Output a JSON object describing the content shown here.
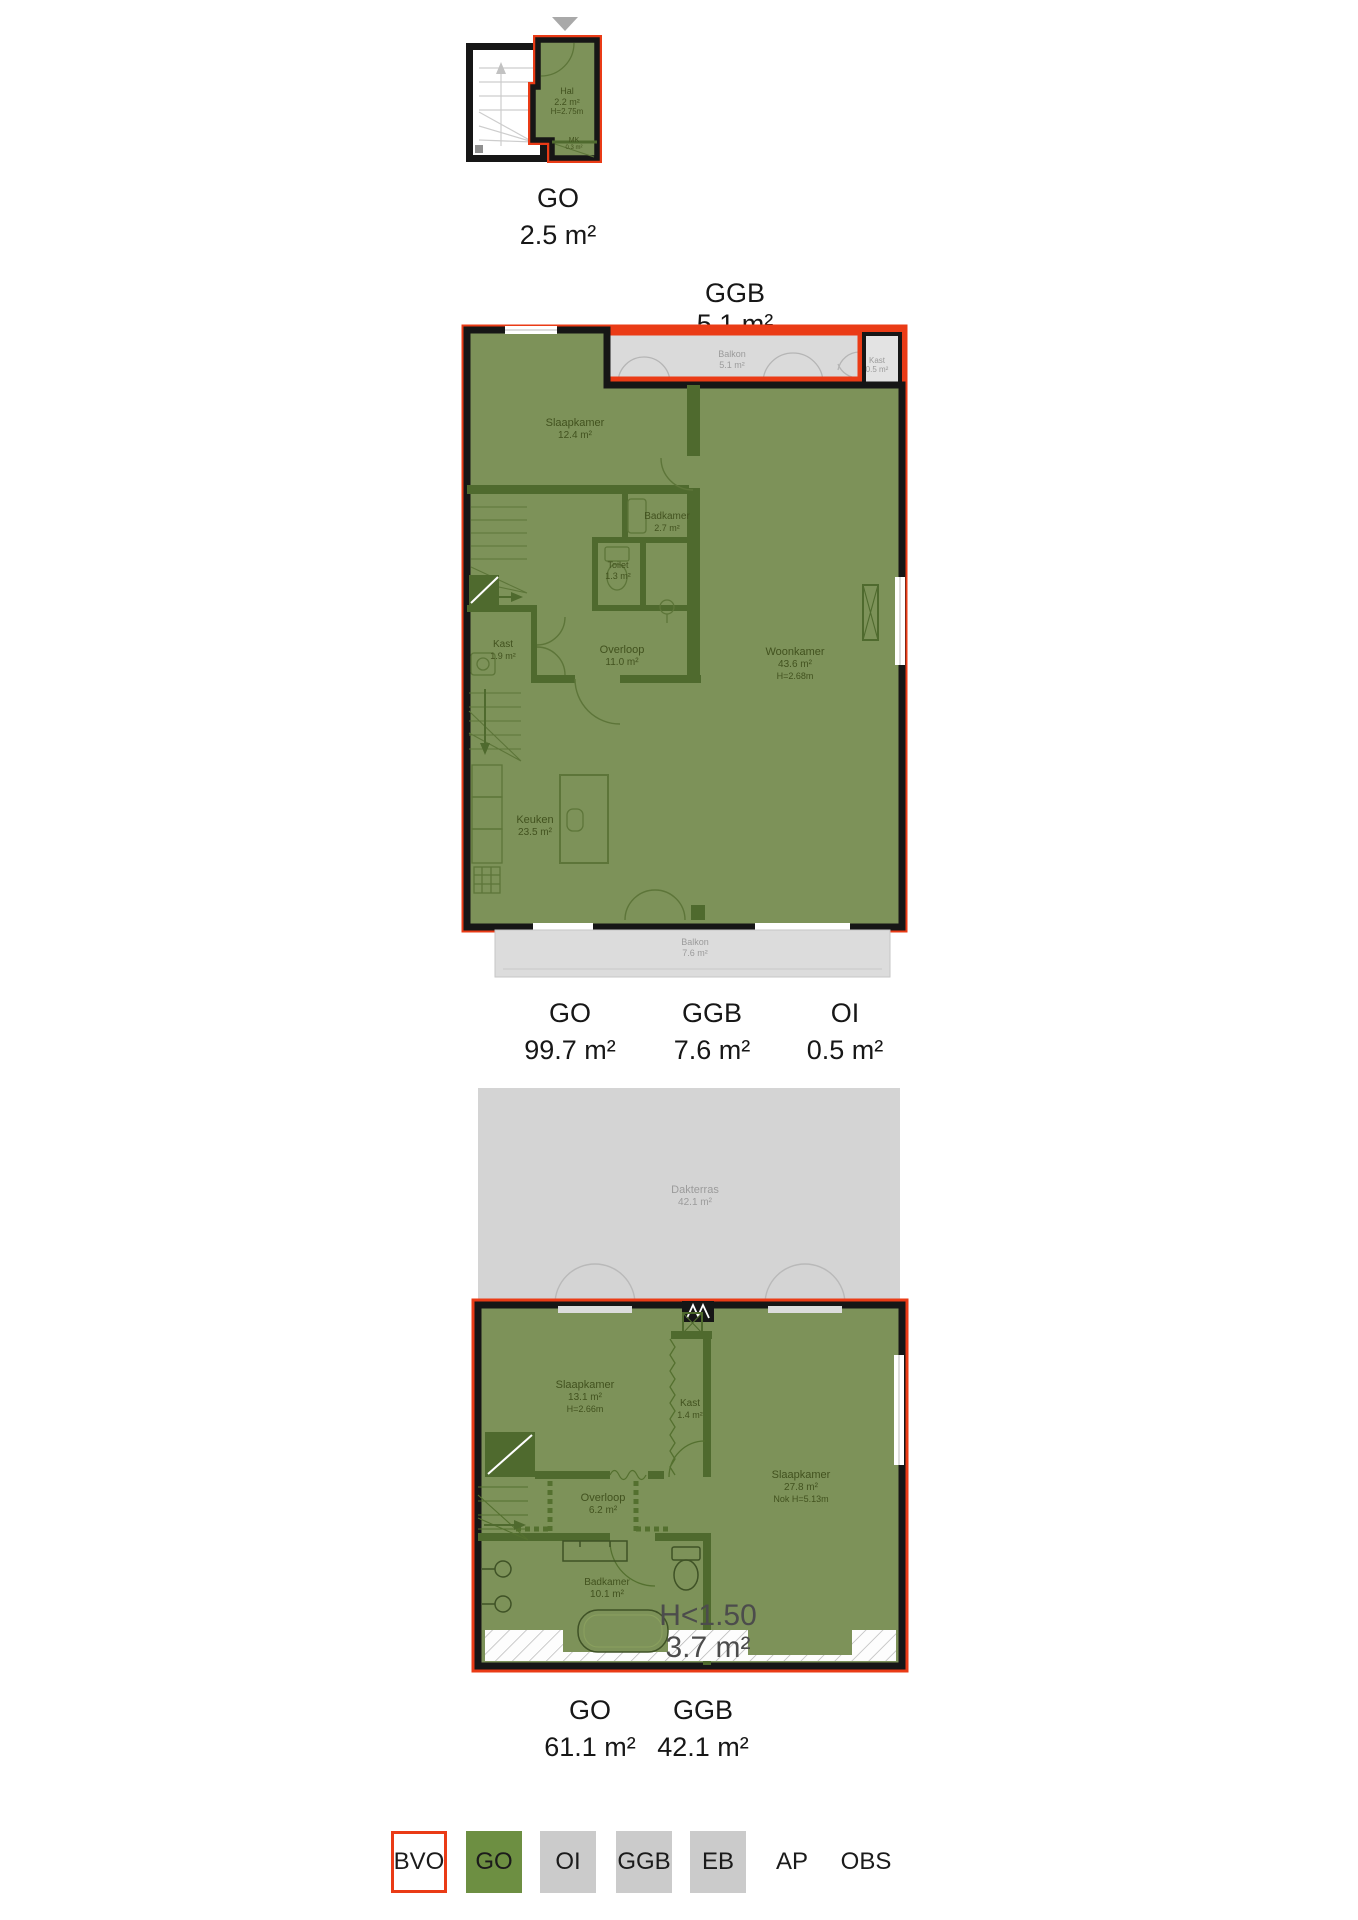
{
  "colors": {
    "bvo_outline_red": "#ea3b16",
    "go_green_fill": "#7d9259",
    "inner_wall_green": "#4f6a2e",
    "wall_black": "#161616",
    "outdoor_gray": "#d4d4d4",
    "legend_gray": "#cbcbcb",
    "legend_green": "#6d8f42"
  },
  "plan_top": {
    "rooms": {
      "hal": {
        "name": "Hal",
        "area": "2.2 m²",
        "height": "H=2.75m"
      },
      "mk": {
        "name": "MK",
        "area": "0.3 m²"
      }
    },
    "summary": [
      {
        "label": "GO",
        "value": "2.5 m²"
      }
    ]
  },
  "plan_middle": {
    "header": {
      "label": "GGB",
      "value": "5.1 m²"
    },
    "rooms": {
      "balkon_top": {
        "name": "Balkon",
        "area": "5.1 m²"
      },
      "kast_oi": {
        "name": "Kast",
        "area": "0.5 m²"
      },
      "slaapkamer": {
        "name": "Slaapkamer",
        "area": "12.4 m²"
      },
      "badkamer": {
        "name": "Badkamer",
        "area": "2.7 m²"
      },
      "toilet": {
        "name": "Toilet",
        "area": "1.3 m²"
      },
      "kast": {
        "name": "Kast",
        "area": "1.9 m²"
      },
      "overloop": {
        "name": "Overloop",
        "area": "11.0 m²"
      },
      "woonkamer": {
        "name": "Woonkamer",
        "area": "43.6 m²",
        "height": "H=2.68m"
      },
      "keuken": {
        "name": "Keuken",
        "area": "23.5 m²"
      },
      "balkon_bottom": {
        "name": "Balkon",
        "area": "7.6 m²"
      }
    },
    "summary": [
      {
        "label": "GO",
        "value": "99.7 m²"
      },
      {
        "label": "GGB",
        "value": "7.6 m²"
      },
      {
        "label": "OI",
        "value": "0.5 m²"
      }
    ]
  },
  "plan_bottom": {
    "rooms": {
      "dakterras": {
        "name": "Dakterras",
        "area": "42.1 m²"
      },
      "slaapkamer_1": {
        "name": "Slaapkamer",
        "area": "13.1 m²",
        "height": "H=2.66m"
      },
      "kast": {
        "name": "Kast",
        "area": "1.4 m²"
      },
      "slaapkamer_2": {
        "name": "Slaapkamer",
        "area": "27.8 m²",
        "height": "Nok H=5.13m"
      },
      "overloop": {
        "name": "Overloop",
        "area": "6.2 m²"
      },
      "badkamer": {
        "name": "Badkamer",
        "area": "10.1 m²"
      },
      "low_headroom": {
        "name": "H<1.50",
        "area": "3.7 m²"
      }
    },
    "summary": [
      {
        "label": "GO",
        "value": "61.1 m²"
      },
      {
        "label": "GGB",
        "value": "42.1 m²"
      }
    ]
  },
  "legend": {
    "items": [
      {
        "label": "BVO",
        "style": "bvo"
      },
      {
        "label": "GO",
        "style": "go"
      },
      {
        "label": "OI",
        "style": "gray"
      },
      {
        "label": "GGB",
        "style": "gray"
      },
      {
        "label": "EB",
        "style": "gray"
      },
      {
        "label": "AP",
        "style": "none"
      },
      {
        "label": "OBS",
        "style": "none"
      }
    ]
  }
}
